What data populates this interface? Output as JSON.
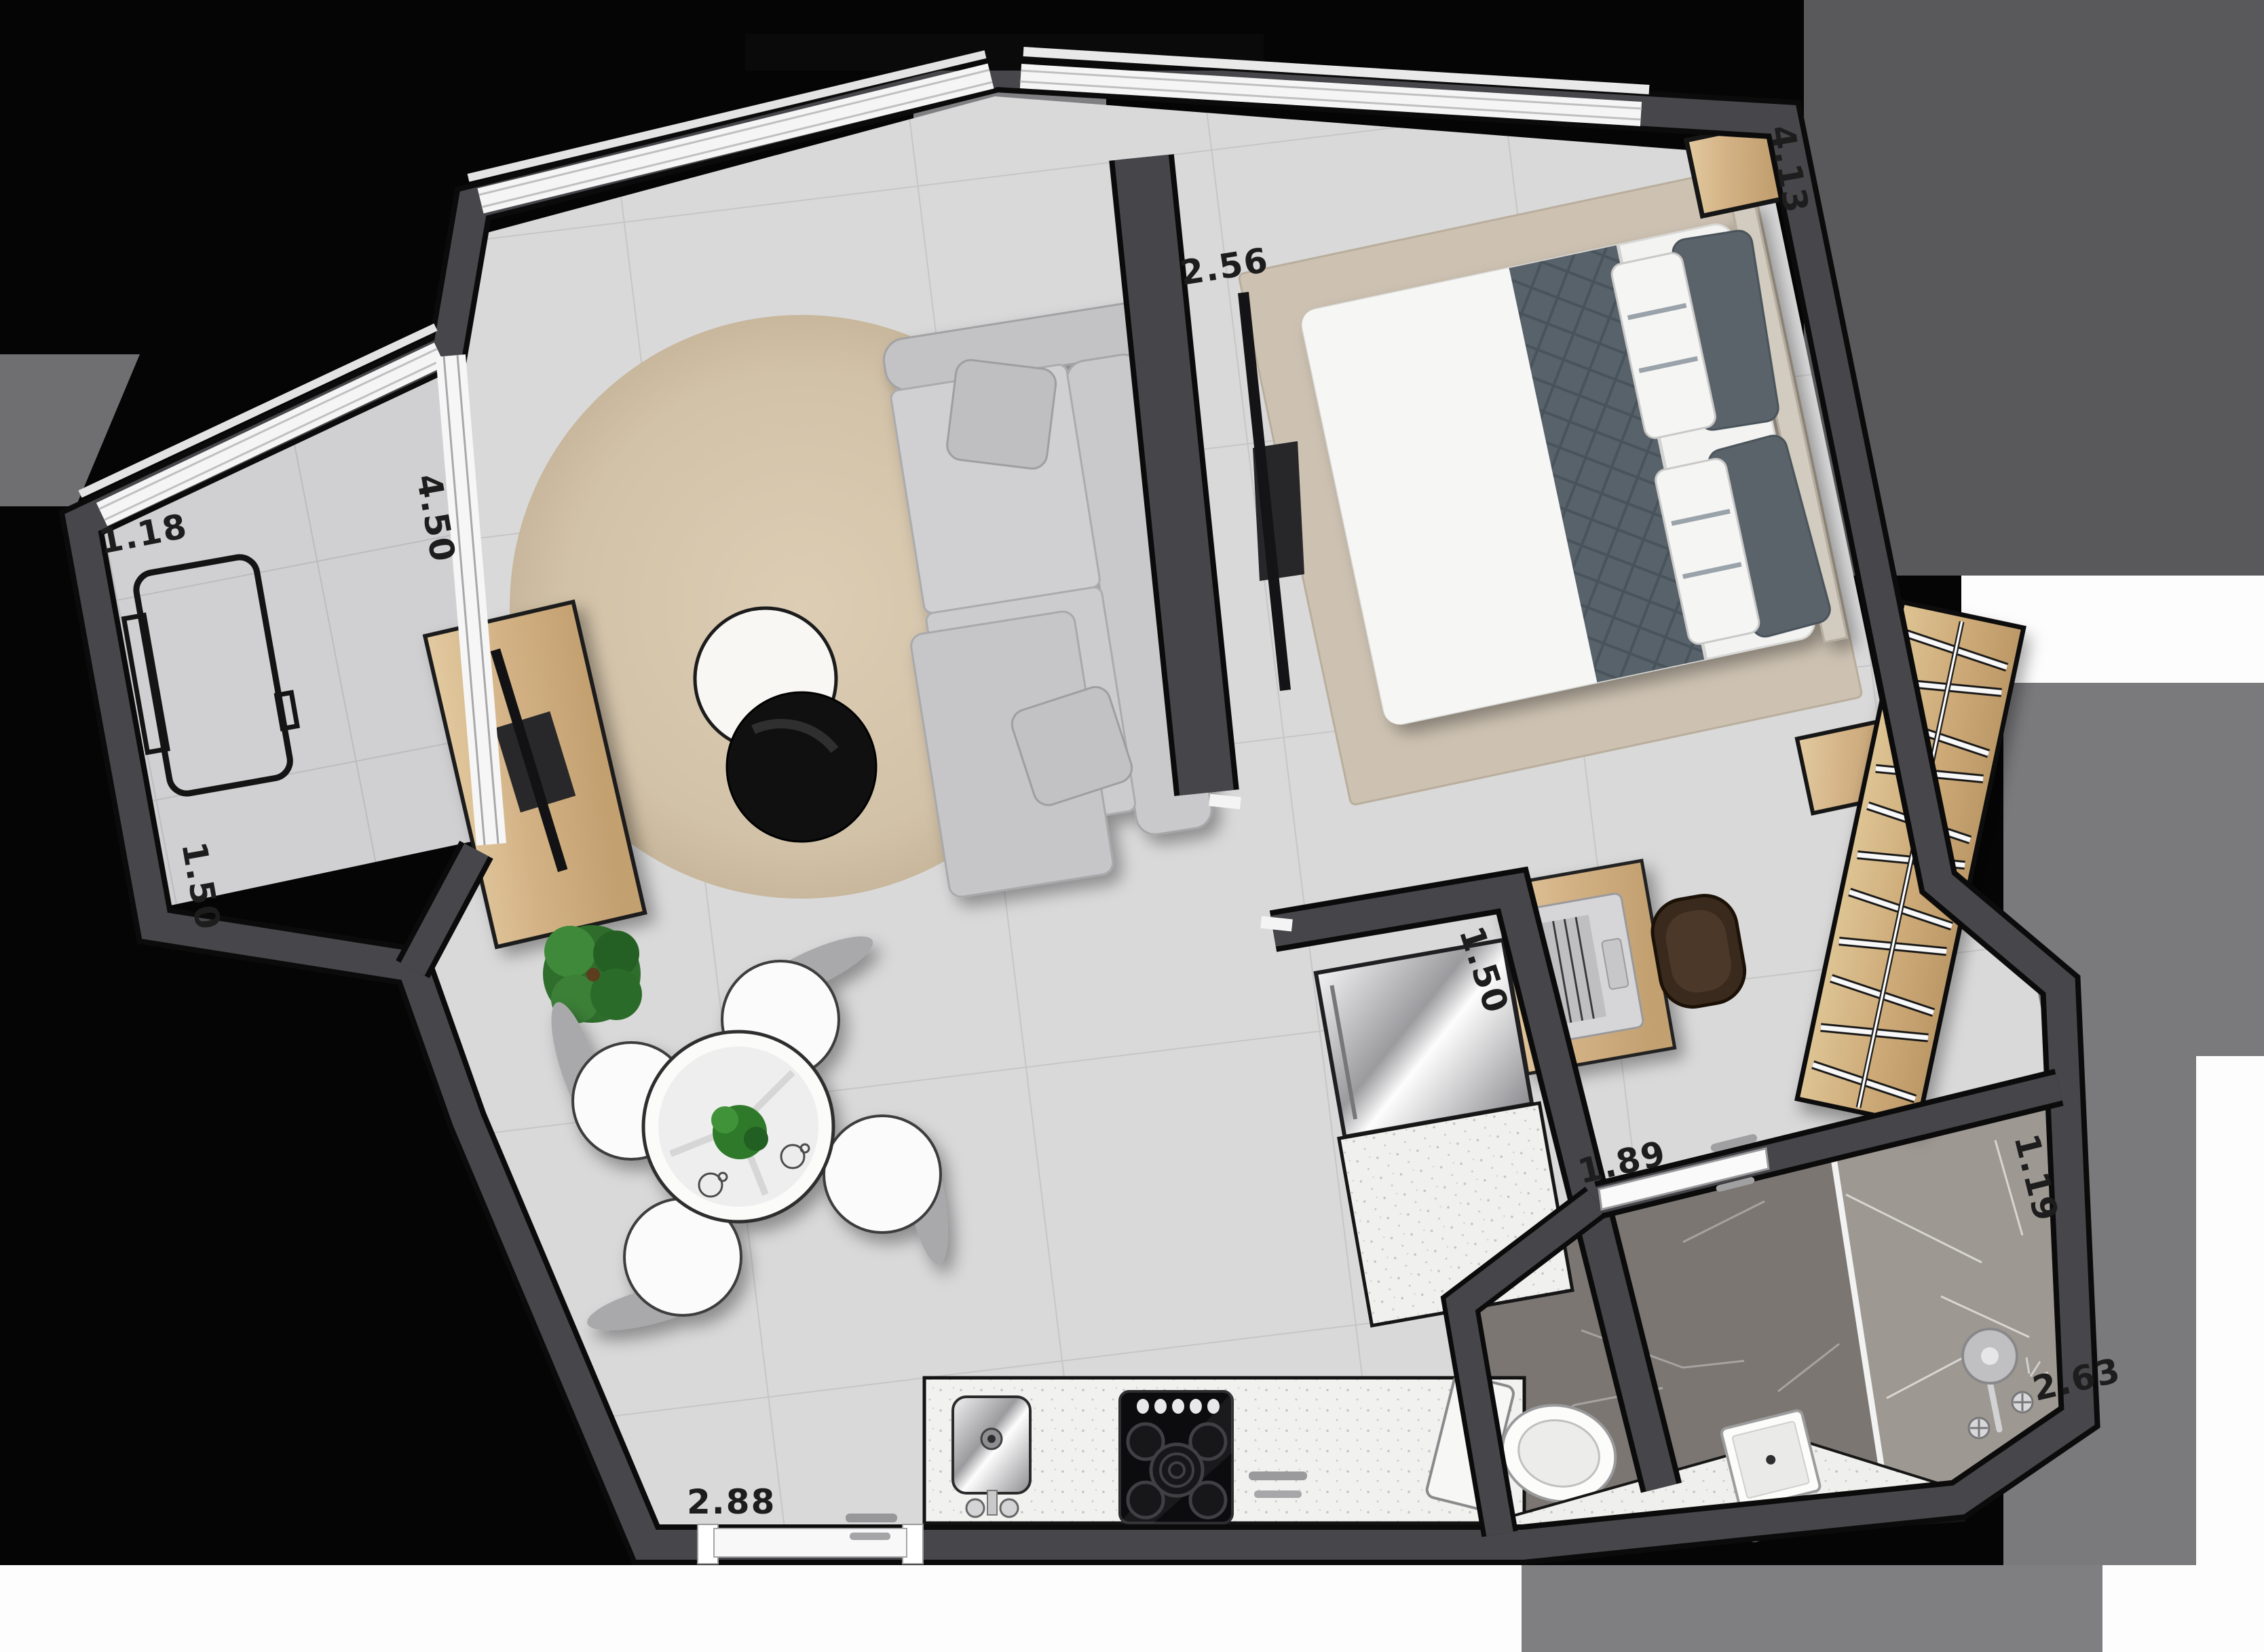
{
  "plan": {
    "kind": "apartment-floor-plan-render",
    "dimension_labels": {
      "balcony_width": "1.18",
      "balcony_depth": "1.50",
      "glass_wall": "4.50",
      "bedroom_width": "2.56",
      "bedroom_length": "4.13",
      "kitchen_recess": "1.50",
      "bathroom_entry": "1.89",
      "shower_width": "1.19",
      "bathroom_length": "2.63",
      "kitchen_width": "2.88"
    },
    "colors": {
      "background": "#000000",
      "wall_core": "#47474b",
      "wall_edge": "#0b0b0b",
      "floor_tile": "#d9d9da",
      "balcony_floor": "#d0d0d2",
      "round_rug": "#d5c5ac",
      "bedroom_rug": "#cdc2b2",
      "wood": "#cfa878",
      "sofa": "#cbcbcd",
      "marble_dark": "#7b7672",
      "marble_light": "#9e9892",
      "counter": "#f0f0ee",
      "steel": "#b9b9bc",
      "plant_green": "#2f7a2b",
      "quilt_gray": "#59626b",
      "label_text": "#1d1d1d",
      "window_white": "#f5f5f5"
    },
    "furniture_icons": [
      "double-bed-icon",
      "round-rug-icon",
      "sofa-icon",
      "coffee-tables-icon",
      "tv-sideboard-icon",
      "flatscreen-tv-icon",
      "dining-table-icon",
      "dining-chair-icon",
      "potted-plant-icon",
      "kitchen-sink-icon",
      "cooktop-icon",
      "refrigerator-icon",
      "kitchen-counter-icon",
      "desk-icon",
      "laptop-icon",
      "desk-chair-icon",
      "wardrobe-hangers-icon",
      "nightstand-icon",
      "toilet-icon",
      "washbasin-icon",
      "shower-icon",
      "vanity-counter-icon",
      "balcony-bench-icon",
      "entry-door-icon",
      "bathroom-door-icon",
      "sliding-door-icon",
      "window-icon"
    ]
  }
}
